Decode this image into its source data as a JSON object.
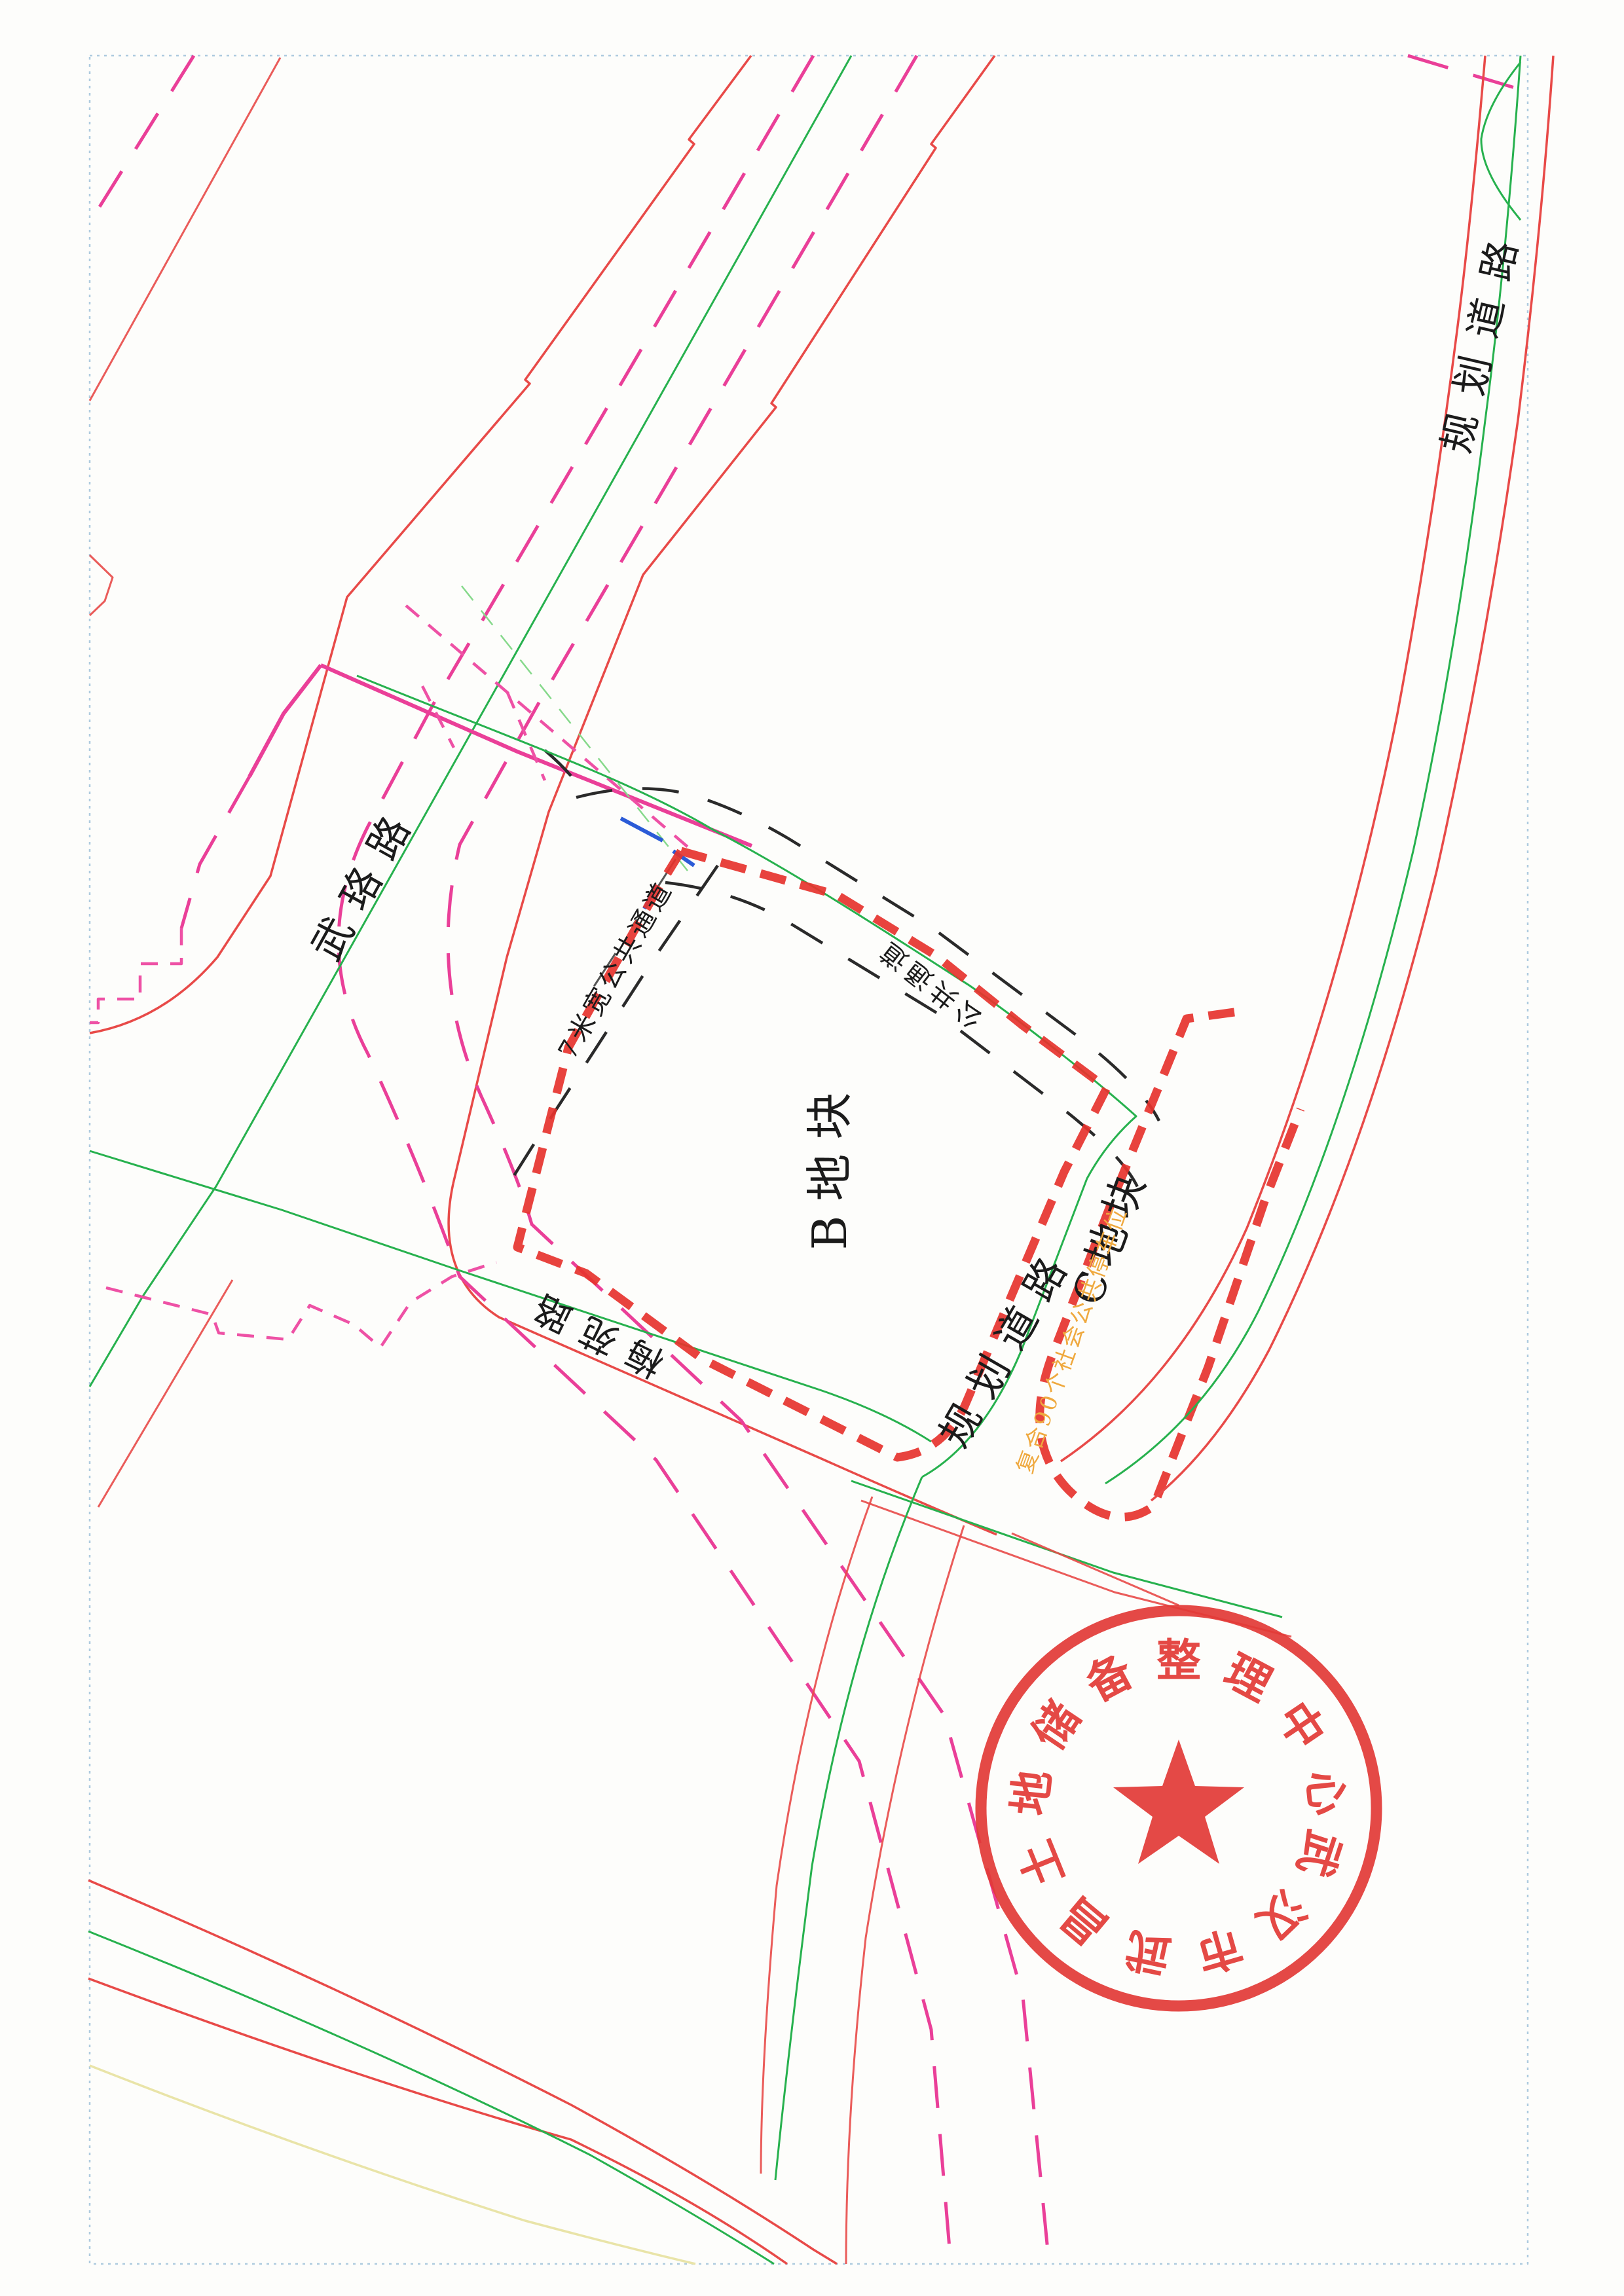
{
  "map": {
    "road_labels": {
      "wuluo_road": "武珞路",
      "meiyuan_road": "梅苑路",
      "planned_road_between_parcels": "规划道路",
      "planned_road_right": "规划道路"
    },
    "parcel_labels": {
      "parcel_b": "B地块",
      "parcel_c": "C地块"
    },
    "annotations": {
      "public_passage_7m": "7米宽公共通道",
      "public_passage": "公共通道",
      "parking_note": "复合90个社会公共停车位"
    }
  },
  "stamp": {
    "text": "武汉市武昌土地储备整理中心",
    "color": "#e23a36"
  },
  "colors": {
    "c-border": "#aecbdf",
    "c-red-line": "#e84a48",
    "c-red-dash": "#e6332e",
    "c-magenta": "#ea3f98",
    "c-magenta2": "#ee51a5",
    "c-green": "#27b14e",
    "c-green-light": "#86d98b",
    "c-black-line": "#2a2a2a",
    "c-blue": "#2b5bd7",
    "c-yellow": "#e9e4a8",
    "c-orange": "#efa93f",
    "c-stamp": "#e23a36"
  }
}
